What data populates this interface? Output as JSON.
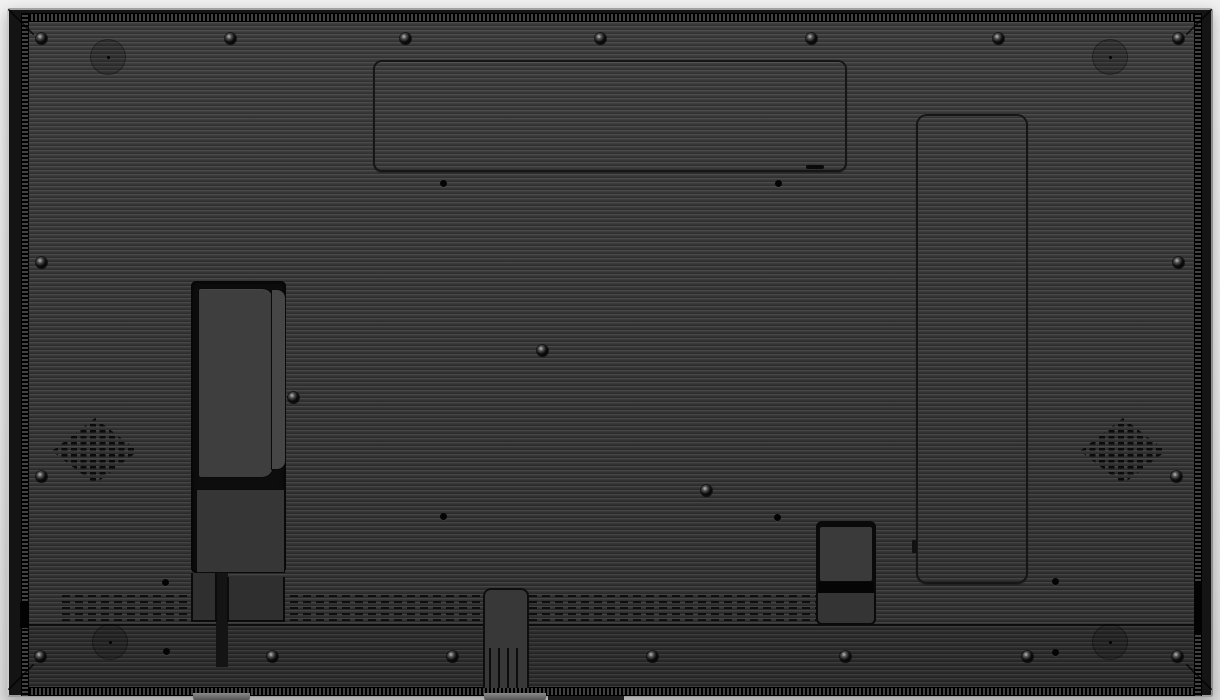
{
  "image": {
    "type": "product-photo",
    "subject": "Rear housing of a large flat-panel display (digital signage monitor), back view on a light background",
    "visible_text": ""
  },
  "colors": {
    "bg_top": "#f0f0f0",
    "bg_mid": "#e9e9e9",
    "bg_bottom": "#dedede",
    "frame": "#141414",
    "rib_light": "#474747",
    "rib_mid": "#383838",
    "rib_dark": "#2a2a2a",
    "vent_dash": "#0e0e0e"
  },
  "features": {
    "back_panel": "rear housing with horizontal ribbed texture",
    "frame_perforation": "perforated vent strips along top, bottom, left and right frame edges",
    "top_access_panel": "rounded rectangular access-panel outline, top center, with latch slot",
    "side_access_panel": "tall rounded access-panel outline, right side, with edge notch",
    "connector_recess": "left recessed connector bay with upper and lower cover plates and two legs",
    "speaker_grille_left": "diamond-shaped perforated speaker grille, left",
    "speaker_grille_right": "diamond-shaped perforated speaker grille, right",
    "vent_band": "rows of ventilation dashes above bottom band",
    "connector_box": "small recessed connector box, bottom right of center",
    "stand_column": "center-bottom cable column with vertical slots and foot",
    "hardware": "screws, molding pads and mounting holes distributed over the panel"
  },
  "hardware": {
    "screws": [
      [
        41,
        38
      ],
      [
        230,
        38
      ],
      [
        405,
        38
      ],
      [
        600,
        38
      ],
      [
        811,
        38
      ],
      [
        998,
        38
      ],
      [
        1178,
        38
      ],
      [
        41,
        262
      ],
      [
        1178,
        262
      ],
      [
        41,
        476
      ],
      [
        1176,
        476
      ],
      [
        542,
        350
      ],
      [
        293,
        397
      ],
      [
        706,
        490
      ],
      [
        40,
        656
      ],
      [
        272,
        656
      ],
      [
        452,
        656
      ],
      [
        652,
        656
      ],
      [
        845,
        656
      ],
      [
        1027,
        656
      ],
      [
        1177,
        656
      ]
    ],
    "holes": [
      [
        443,
        183
      ],
      [
        778,
        183
      ],
      [
        443,
        516
      ],
      [
        777,
        517
      ],
      [
        165,
        582
      ],
      [
        166,
        651
      ],
      [
        1055,
        581
      ],
      [
        1055,
        652
      ]
    ],
    "pads": [
      [
        108,
        57
      ],
      [
        1110,
        57
      ],
      [
        110,
        642
      ],
      [
        1110,
        642
      ]
    ]
  },
  "vents": {
    "band_top_y": 595,
    "band_height": 29,
    "segments_x": [
      [
        62,
        190
      ],
      [
        290,
        482
      ],
      [
        529,
        816
      ]
    ]
  }
}
